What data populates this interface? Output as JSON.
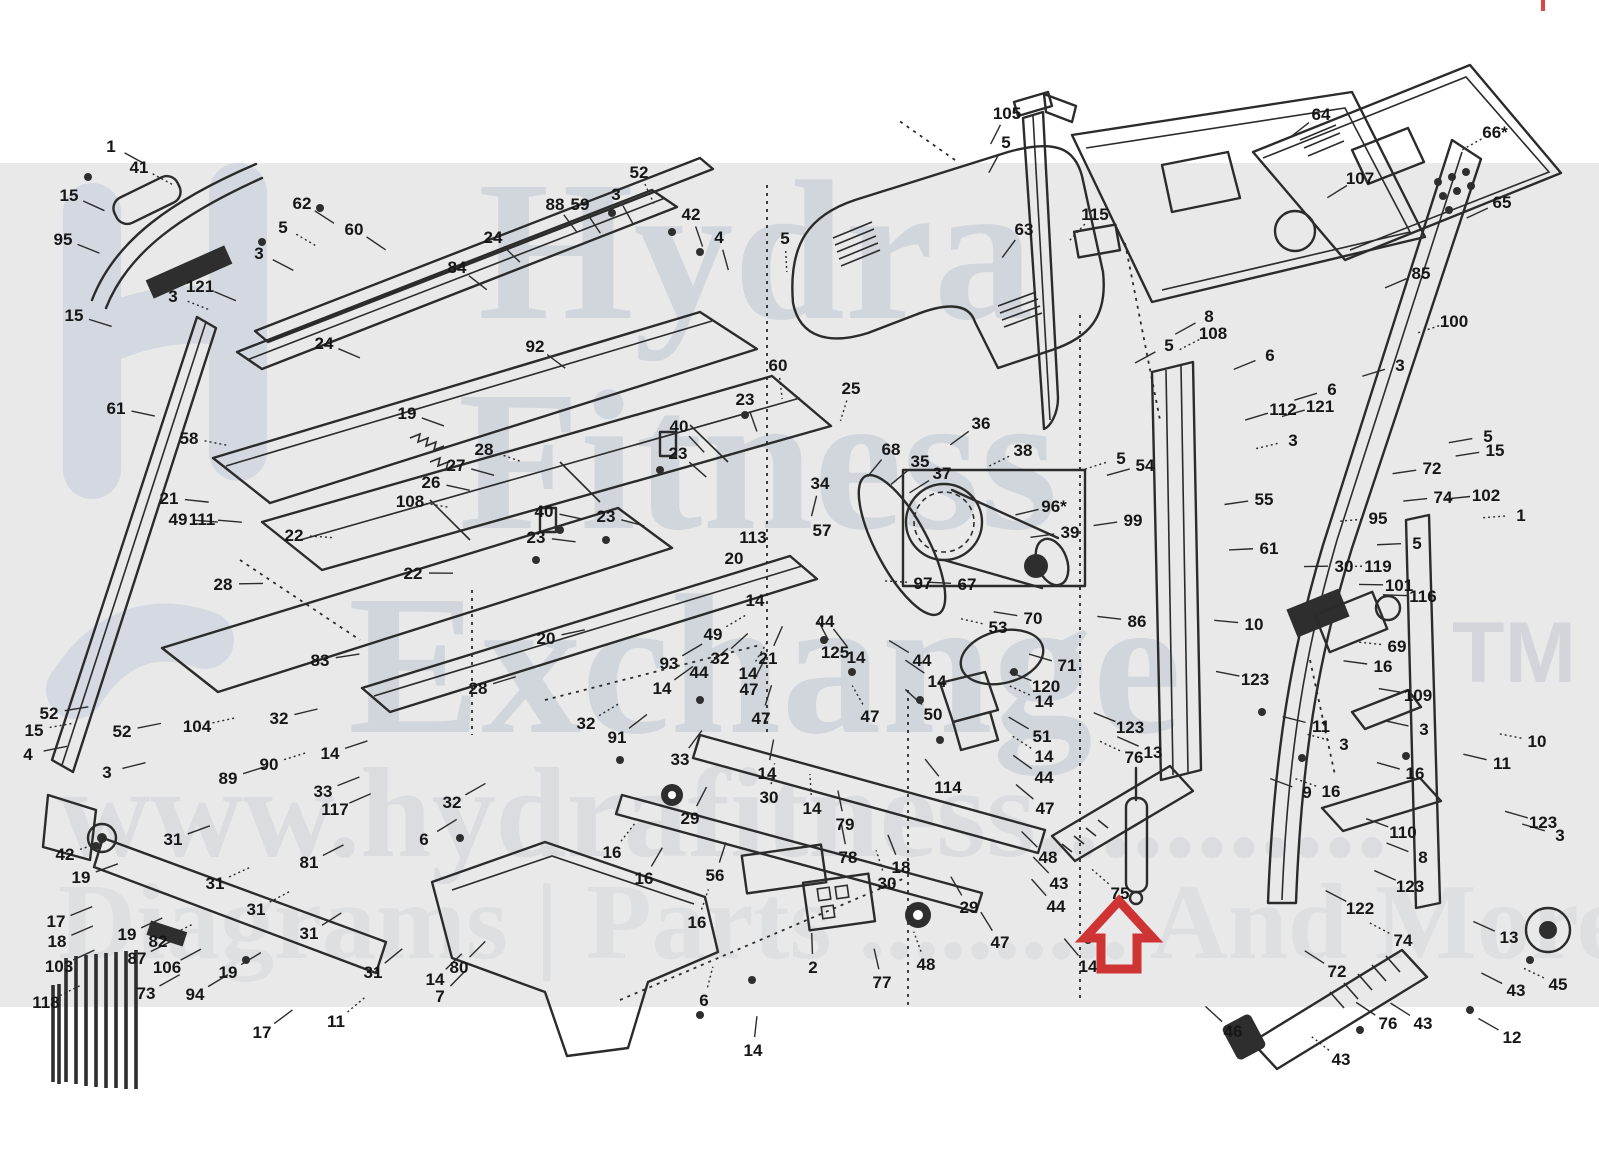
{
  "page": {
    "background": "#ffffff",
    "band_color": "#e9e9e9",
    "band_top": 163,
    "band_bottom": 1007,
    "line_color": "#2b2b2b",
    "label_color": "#161616"
  },
  "watermark": {
    "logo_color": "#b9c4d8",
    "text_color": "#bfc7d4",
    "url_color": "#ced2d9",
    "bottom_color": "#d6d7da",
    "row1": "Hydra",
    "row2": "Fitness",
    "row3": "Exchange",
    "tm": "TM",
    "url_row": "www.hydrafitness...........",
    "bottom_row": "Diagrams | Parts .......... And More"
  },
  "highlight": {
    "part": "75",
    "arrow_color": "#cf3434",
    "direction": "up"
  },
  "labels": [
    {
      "t": "1",
      "x": 111,
      "y": 146
    },
    {
      "t": "41",
      "x": 139,
      "y": 167
    },
    {
      "t": "15",
      "x": 69,
      "y": 195
    },
    {
      "t": "95",
      "x": 63,
      "y": 239
    },
    {
      "t": "62",
      "x": 302,
      "y": 203
    },
    {
      "t": "5",
      "x": 283,
      "y": 227
    },
    {
      "t": "3",
      "x": 259,
      "y": 253
    },
    {
      "t": "60",
      "x": 354,
      "y": 229
    },
    {
      "t": "121",
      "x": 200,
      "y": 286
    },
    {
      "t": "3",
      "x": 173,
      "y": 296
    },
    {
      "t": "15",
      "x": 74,
      "y": 315
    },
    {
      "t": "61",
      "x": 116,
      "y": 408
    },
    {
      "t": "24",
      "x": 324,
      "y": 343
    },
    {
      "t": "58",
      "x": 189,
      "y": 438
    },
    {
      "t": "21",
      "x": 169,
      "y": 498
    },
    {
      "t": "49",
      "x": 178,
      "y": 519
    },
    {
      "t": "111",
      "x": 202,
      "y": 519
    },
    {
      "t": "22",
      "x": 294,
      "y": 535
    },
    {
      "t": "28",
      "x": 223,
      "y": 584
    },
    {
      "t": "88",
      "x": 555,
      "y": 204
    },
    {
      "t": "59",
      "x": 580,
      "y": 204
    },
    {
      "t": "52",
      "x": 639,
      "y": 172
    },
    {
      "t": "3",
      "x": 616,
      "y": 194
    },
    {
      "t": "42",
      "x": 691,
      "y": 214
    },
    {
      "t": "4",
      "x": 719,
      "y": 237
    },
    {
      "t": "5",
      "x": 785,
      "y": 238
    },
    {
      "t": "24",
      "x": 493,
      "y": 237
    },
    {
      "t": "84",
      "x": 457,
      "y": 267
    },
    {
      "t": "92",
      "x": 535,
      "y": 346
    },
    {
      "t": "60",
      "x": 778,
      "y": 365
    },
    {
      "t": "19",
      "x": 407,
      "y": 413
    },
    {
      "t": "26",
      "x": 431,
      "y": 482
    },
    {
      "t": "27",
      "x": 456,
      "y": 465
    },
    {
      "t": "28",
      "x": 484,
      "y": 449
    },
    {
      "t": "23",
      "x": 745,
      "y": 399
    },
    {
      "t": "40",
      "x": 679,
      "y": 426
    },
    {
      "t": "23",
      "x": 678,
      "y": 453
    },
    {
      "t": "108",
      "x": 410,
      "y": 501
    },
    {
      "t": "40",
      "x": 544,
      "y": 511
    },
    {
      "t": "23",
      "x": 606,
      "y": 516
    },
    {
      "t": "23",
      "x": 536,
      "y": 537
    },
    {
      "t": "113",
      "x": 753,
      "y": 537
    },
    {
      "t": "20",
      "x": 734,
      "y": 558
    },
    {
      "t": "22",
      "x": 413,
      "y": 573
    },
    {
      "t": "34",
      "x": 820,
      "y": 483
    },
    {
      "t": "25",
      "x": 851,
      "y": 388
    },
    {
      "t": "35",
      "x": 920,
      "y": 461
    },
    {
      "t": "36",
      "x": 981,
      "y": 423
    },
    {
      "t": "37",
      "x": 942,
      "y": 473
    },
    {
      "t": "38",
      "x": 1023,
      "y": 450
    },
    {
      "t": "68",
      "x": 891,
      "y": 449
    },
    {
      "t": "57",
      "x": 822,
      "y": 530
    },
    {
      "t": "96*",
      "x": 1054,
      "y": 506
    },
    {
      "t": "97",
      "x": 923,
      "y": 583
    },
    {
      "t": "67",
      "x": 967,
      "y": 584
    },
    {
      "t": "39",
      "x": 1070,
      "y": 532
    },
    {
      "t": "99",
      "x": 1133,
      "y": 520
    },
    {
      "t": "5",
      "x": 1121,
      "y": 458
    },
    {
      "t": "54",
      "x": 1145,
      "y": 465
    },
    {
      "t": "105",
      "x": 1007,
      "y": 113
    },
    {
      "t": "5",
      "x": 1006,
      "y": 142
    },
    {
      "t": "115",
      "x": 1095,
      "y": 214
    },
    {
      "t": "63",
      "x": 1024,
      "y": 229
    },
    {
      "t": "64",
      "x": 1321,
      "y": 114
    },
    {
      "t": "107",
      "x": 1360,
      "y": 178
    },
    {
      "t": "66*",
      "x": 1495,
      "y": 132
    },
    {
      "t": "65",
      "x": 1502,
      "y": 202
    },
    {
      "t": "85",
      "x": 1421,
      "y": 273
    },
    {
      "t": "8",
      "x": 1209,
      "y": 316
    },
    {
      "t": "108",
      "x": 1213,
      "y": 333
    },
    {
      "t": "5",
      "x": 1169,
      "y": 345
    },
    {
      "t": "6",
      "x": 1270,
      "y": 355
    },
    {
      "t": "6",
      "x": 1332,
      "y": 389
    },
    {
      "t": "100",
      "x": 1454,
      "y": 321
    },
    {
      "t": "3",
      "x": 1400,
      "y": 365
    },
    {
      "t": "112",
      "x": 1283,
      "y": 409
    },
    {
      "t": "121",
      "x": 1320,
      "y": 406
    },
    {
      "t": "3",
      "x": 1293,
      "y": 440
    },
    {
      "t": "5",
      "x": 1488,
      "y": 436
    },
    {
      "t": "15",
      "x": 1495,
      "y": 450
    },
    {
      "t": "55",
      "x": 1264,
      "y": 499
    },
    {
      "t": "95",
      "x": 1378,
      "y": 518
    },
    {
      "t": "72",
      "x": 1432,
      "y": 468
    },
    {
      "t": "74",
      "x": 1443,
      "y": 497
    },
    {
      "t": "102",
      "x": 1486,
      "y": 495
    },
    {
      "t": "1",
      "x": 1521,
      "y": 515
    },
    {
      "t": "5",
      "x": 1417,
      "y": 543
    },
    {
      "t": "61",
      "x": 1269,
      "y": 548
    },
    {
      "t": "30",
      "x": 1344,
      "y": 566
    },
    {
      "t": "119",
      "x": 1378,
      "y": 566
    },
    {
      "t": "101",
      "x": 1399,
      "y": 585
    },
    {
      "t": "116",
      "x": 1423,
      "y": 596
    },
    {
      "t": "52",
      "x": 49,
      "y": 713
    },
    {
      "t": "15",
      "x": 34,
      "y": 730
    },
    {
      "t": "4",
      "x": 28,
      "y": 754
    },
    {
      "t": "52",
      "x": 122,
      "y": 731
    },
    {
      "t": "3",
      "x": 107,
      "y": 772
    },
    {
      "t": "104",
      "x": 197,
      "y": 726
    },
    {
      "t": "83",
      "x": 320,
      "y": 660
    },
    {
      "t": "32",
      "x": 279,
      "y": 718
    },
    {
      "t": "14",
      "x": 330,
      "y": 753
    },
    {
      "t": "90",
      "x": 269,
      "y": 764
    },
    {
      "t": "89",
      "x": 228,
      "y": 778
    },
    {
      "t": "33",
      "x": 323,
      "y": 791
    },
    {
      "t": "117",
      "x": 335,
      "y": 809
    },
    {
      "t": "42",
      "x": 65,
      "y": 854
    },
    {
      "t": "31",
      "x": 173,
      "y": 839
    },
    {
      "t": "19",
      "x": 81,
      "y": 877
    },
    {
      "t": "81",
      "x": 309,
      "y": 862
    },
    {
      "t": "31",
      "x": 215,
      "y": 883
    },
    {
      "t": "17",
      "x": 56,
      "y": 921
    },
    {
      "t": "18",
      "x": 57,
      "y": 941
    },
    {
      "t": "19",
      "x": 127,
      "y": 934
    },
    {
      "t": "82",
      "x": 158,
      "y": 941
    },
    {
      "t": "87",
      "x": 137,
      "y": 958
    },
    {
      "t": "103",
      "x": 59,
      "y": 966
    },
    {
      "t": "106",
      "x": 167,
      "y": 967
    },
    {
      "t": "31",
      "x": 256,
      "y": 909
    },
    {
      "t": "31",
      "x": 309,
      "y": 933
    },
    {
      "t": "31",
      "x": 373,
      "y": 972
    },
    {
      "t": "73",
      "x": 146,
      "y": 993
    },
    {
      "t": "118",
      "x": 46,
      "y": 1002
    },
    {
      "t": "94",
      "x": 195,
      "y": 994
    },
    {
      "t": "19",
      "x": 228,
      "y": 972
    },
    {
      "t": "17",
      "x": 262,
      "y": 1032
    },
    {
      "t": "11",
      "x": 336,
      "y": 1021
    },
    {
      "t": "20",
      "x": 546,
      "y": 638
    },
    {
      "t": "93",
      "x": 669,
      "y": 663
    },
    {
      "t": "28",
      "x": 478,
      "y": 688
    },
    {
      "t": "49",
      "x": 713,
      "y": 634
    },
    {
      "t": "32",
      "x": 720,
      "y": 658
    },
    {
      "t": "21",
      "x": 768,
      "y": 658
    },
    {
      "t": "44",
      "x": 699,
      "y": 672
    },
    {
      "t": "14",
      "x": 748,
      "y": 673
    },
    {
      "t": "14",
      "x": 662,
      "y": 688
    },
    {
      "t": "47",
      "x": 749,
      "y": 689
    },
    {
      "t": "47",
      "x": 761,
      "y": 718
    },
    {
      "t": "32",
      "x": 586,
      "y": 723
    },
    {
      "t": "91",
      "x": 617,
      "y": 737
    },
    {
      "t": "33",
      "x": 680,
      "y": 759
    },
    {
      "t": "14",
      "x": 767,
      "y": 773
    },
    {
      "t": "30",
      "x": 769,
      "y": 797
    },
    {
      "t": "32",
      "x": 452,
      "y": 802
    },
    {
      "t": "29",
      "x": 690,
      "y": 818
    },
    {
      "t": "6",
      "x": 424,
      "y": 839
    },
    {
      "t": "16",
      "x": 612,
      "y": 852
    },
    {
      "t": "16",
      "x": 644,
      "y": 878
    },
    {
      "t": "56",
      "x": 715,
      "y": 875
    },
    {
      "t": "14",
      "x": 755,
      "y": 600
    },
    {
      "t": "16",
      "x": 697,
      "y": 922
    },
    {
      "t": "80",
      "x": 459,
      "y": 967
    },
    {
      "t": "14",
      "x": 435,
      "y": 979
    },
    {
      "t": "7",
      "x": 440,
      "y": 996
    },
    {
      "t": "6",
      "x": 704,
      "y": 1000
    },
    {
      "t": "14",
      "x": 753,
      "y": 1050
    },
    {
      "t": "2",
      "x": 813,
      "y": 967
    },
    {
      "t": "77",
      "x": 882,
      "y": 982
    },
    {
      "t": "48",
      "x": 926,
      "y": 964
    },
    {
      "t": "29",
      "x": 969,
      "y": 907
    },
    {
      "t": "47",
      "x": 1000,
      "y": 942
    },
    {
      "t": "14",
      "x": 1088,
      "y": 966
    },
    {
      "t": "30",
      "x": 887,
      "y": 883
    },
    {
      "t": "18",
      "x": 901,
      "y": 867
    },
    {
      "t": "43",
      "x": 1059,
      "y": 883
    },
    {
      "t": "44",
      "x": 1056,
      "y": 906
    },
    {
      "t": "75",
      "x": 1120,
      "y": 893
    },
    {
      "t": "48",
      "x": 1048,
      "y": 857
    },
    {
      "t": "78",
      "x": 848,
      "y": 857
    },
    {
      "t": "79",
      "x": 845,
      "y": 824
    },
    {
      "t": "14",
      "x": 812,
      "y": 808
    },
    {
      "t": "44",
      "x": 825,
      "y": 621
    },
    {
      "t": "125",
      "x": 835,
      "y": 652
    },
    {
      "t": "14",
      "x": 856,
      "y": 657
    },
    {
      "t": "53",
      "x": 998,
      "y": 627
    },
    {
      "t": "70",
      "x": 1033,
      "y": 618
    },
    {
      "t": "71",
      "x": 1067,
      "y": 665
    },
    {
      "t": "120",
      "x": 1046,
      "y": 686
    },
    {
      "t": "14",
      "x": 1044,
      "y": 701
    },
    {
      "t": "44",
      "x": 922,
      "y": 660
    },
    {
      "t": "14",
      "x": 937,
      "y": 681
    },
    {
      "t": "50",
      "x": 933,
      "y": 714
    },
    {
      "t": "47",
      "x": 870,
      "y": 716
    },
    {
      "t": "51",
      "x": 1042,
      "y": 736
    },
    {
      "t": "123",
      "x": 1130,
      "y": 727
    },
    {
      "t": "86",
      "x": 1137,
      "y": 621
    },
    {
      "t": "14",
      "x": 1044,
      "y": 756
    },
    {
      "t": "44",
      "x": 1044,
      "y": 777
    },
    {
      "t": "114",
      "x": 948,
      "y": 787
    },
    {
      "t": "47",
      "x": 1045,
      "y": 808
    },
    {
      "t": "76",
      "x": 1134,
      "y": 757
    },
    {
      "t": "13",
      "x": 1153,
      "y": 752
    },
    {
      "t": "10",
      "x": 1254,
      "y": 624
    },
    {
      "t": "123",
      "x": 1255,
      "y": 679
    },
    {
      "t": "69",
      "x": 1397,
      "y": 646
    },
    {
      "t": "16",
      "x": 1383,
      "y": 666
    },
    {
      "t": "109",
      "x": 1418,
      "y": 695
    },
    {
      "t": "11",
      "x": 1321,
      "y": 726
    },
    {
      "t": "3",
      "x": 1344,
      "y": 744
    },
    {
      "t": "3",
      "x": 1424,
      "y": 729
    },
    {
      "t": "16",
      "x": 1415,
      "y": 773
    },
    {
      "t": "9",
      "x": 1307,
      "y": 792
    },
    {
      "t": "16",
      "x": 1331,
      "y": 791
    },
    {
      "t": "110",
      "x": 1403,
      "y": 832
    },
    {
      "t": "8",
      "x": 1423,
      "y": 857
    },
    {
      "t": "11",
      "x": 1502,
      "y": 763
    },
    {
      "t": "10",
      "x": 1537,
      "y": 741
    },
    {
      "t": "123",
      "x": 1543,
      "y": 822
    },
    {
      "t": "3",
      "x": 1560,
      "y": 835
    },
    {
      "t": "122",
      "x": 1360,
      "y": 908
    },
    {
      "t": "74",
      "x": 1403,
      "y": 940
    },
    {
      "t": "72",
      "x": 1337,
      "y": 971
    },
    {
      "t": "13",
      "x": 1509,
      "y": 937
    },
    {
      "t": "43",
      "x": 1516,
      "y": 990
    },
    {
      "t": "45",
      "x": 1558,
      "y": 984
    },
    {
      "t": "76",
      "x": 1388,
      "y": 1023
    },
    {
      "t": "43",
      "x": 1423,
      "y": 1023
    },
    {
      "t": "46",
      "x": 1233,
      "y": 1031
    },
    {
      "t": "43",
      "x": 1341,
      "y": 1059
    },
    {
      "t": "12",
      "x": 1512,
      "y": 1037
    },
    {
      "t": "123",
      "x": 1410,
      "y": 886
    }
  ]
}
